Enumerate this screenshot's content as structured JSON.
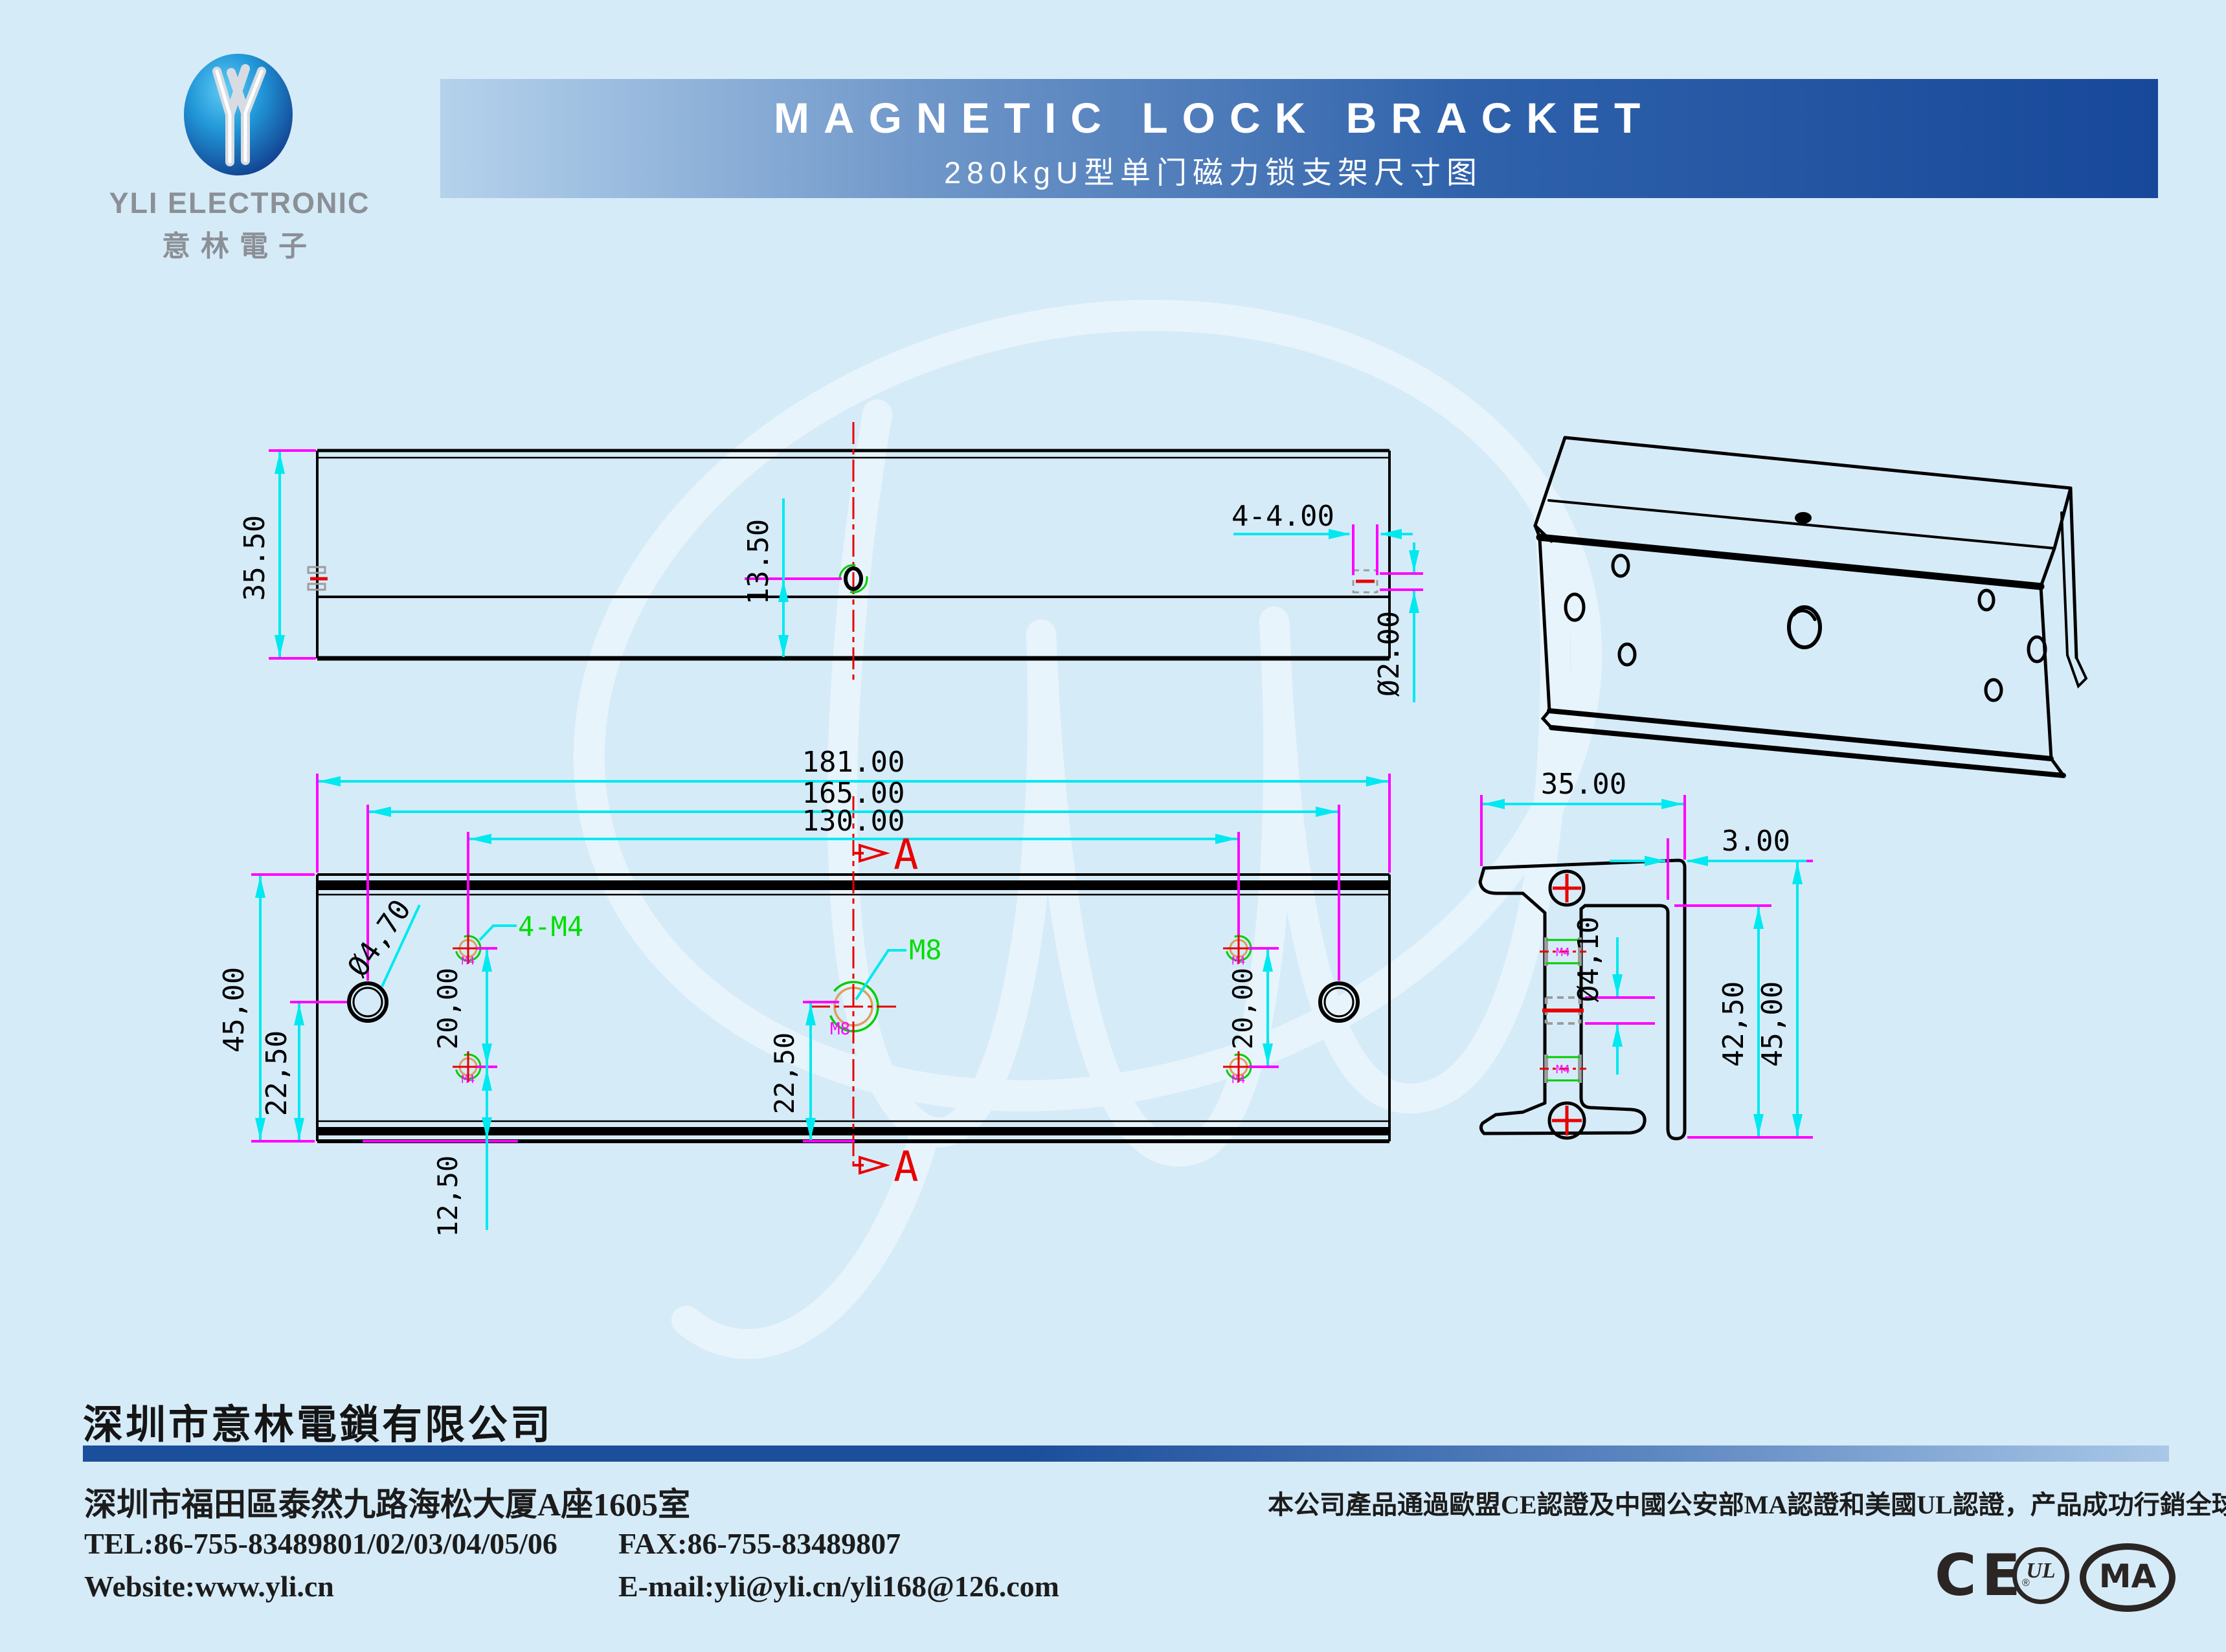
{
  "header": {
    "logo": {
      "name": "YLI ELECTRONIC",
      "name_cn": "意林電子"
    },
    "banner": {
      "title": "MAGNETIC LOCK BRACKET",
      "subtitle": "280kgU型单门磁力锁支架尺寸图"
    }
  },
  "views": {
    "top": {
      "height": "35.50",
      "hole_offset": "13.50",
      "holes": "4-4.00",
      "hole_dia": "Ø2.00"
    },
    "front": {
      "width": "181.00",
      "big_hole_span": "165.00",
      "m4_span": "130.00",
      "height": "45,00",
      "edge_to_center": "22,50",
      "pitch": "20,00",
      "m4_edge": "12,50",
      "big_hole_dia": "Ø4,70",
      "m4_callout": "4-M4",
      "m8_callout": "M8",
      "m8_mark": "M8",
      "m4_mark": "M4",
      "section_label": "A"
    },
    "section": {
      "width": "35.00",
      "wall": "3.00",
      "hole_dia": "Ø4,10",
      "inner_height": "42,50",
      "height": "45,00",
      "m4_mark": "M4"
    }
  },
  "footer": {
    "company": "深圳市意林電鎖有限公司",
    "address": "深圳市福田區泰然九路海松大厦A座1605室",
    "tel": "TEL:86-755-83489801/02/03/04/05/06",
    "fax": "FAX:86-755-83489807",
    "website": "Website:www.yli.cn",
    "email": "E-mail:yli@yli.cn/yli168@126.com",
    "note": "本公司產品通過歐盟CE認證及中國公安部MA認證和美國UL認證，产品成功行銷全球100余國。",
    "cert_ce": "CE",
    "cert_ul": "UL",
    "cert_ul_reg": "®",
    "cert_ma": "MA"
  }
}
